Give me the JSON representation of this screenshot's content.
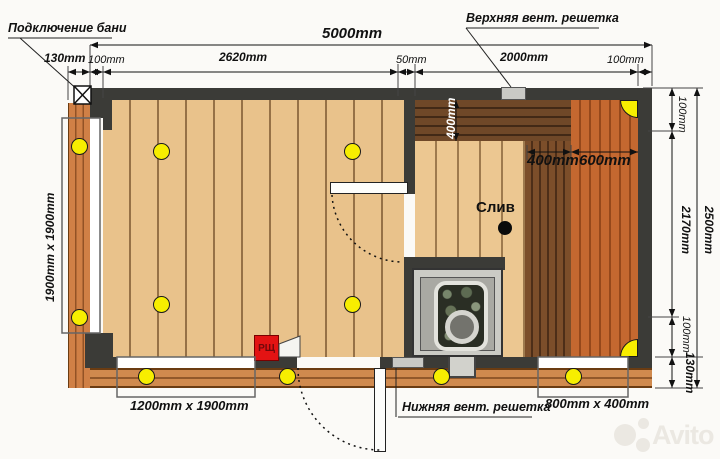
{
  "annotations": {
    "bath_connection": "Подключение бани",
    "upper_vent": "Верхняя вент. решетка",
    "lower_vent": "Нижняя вент. решетка",
    "drain": "Слив",
    "electrical_panel": "РЩ"
  },
  "dimensions": {
    "overall_width": "5000mm",
    "cladding_left": "130mm",
    "wall_left": "100mm",
    "washroom_width": "2620mm",
    "partition": "50mm",
    "sauna_width": "2000mm",
    "wall_right": "100mm",
    "wall_top": "100mm",
    "interior_depth": "2170mm",
    "overall_depth": "2500mm",
    "wall_bottom": "100mm",
    "porch_depth": "130mm",
    "bench_top_depth": "400mm",
    "bench_step_width": "400mm",
    "bench_main_width": "600mm"
  },
  "windows": {
    "left": "1900mm x 1900mm",
    "front_left": "1200mm x 1900mm",
    "front_right": "800mm x 400mm"
  },
  "watermark": {
    "text": "Avito"
  },
  "colors": {
    "wall": "#3b3b37",
    "pine_floor": "#e9c28b",
    "terrace_wood": "#d08a4e",
    "bench_dark": "#6f4828",
    "bench_step": "#7c4e2a",
    "bench_main": "#c46830",
    "accent_yellow": "#f7ee00",
    "panel_red": "#e31313"
  }
}
